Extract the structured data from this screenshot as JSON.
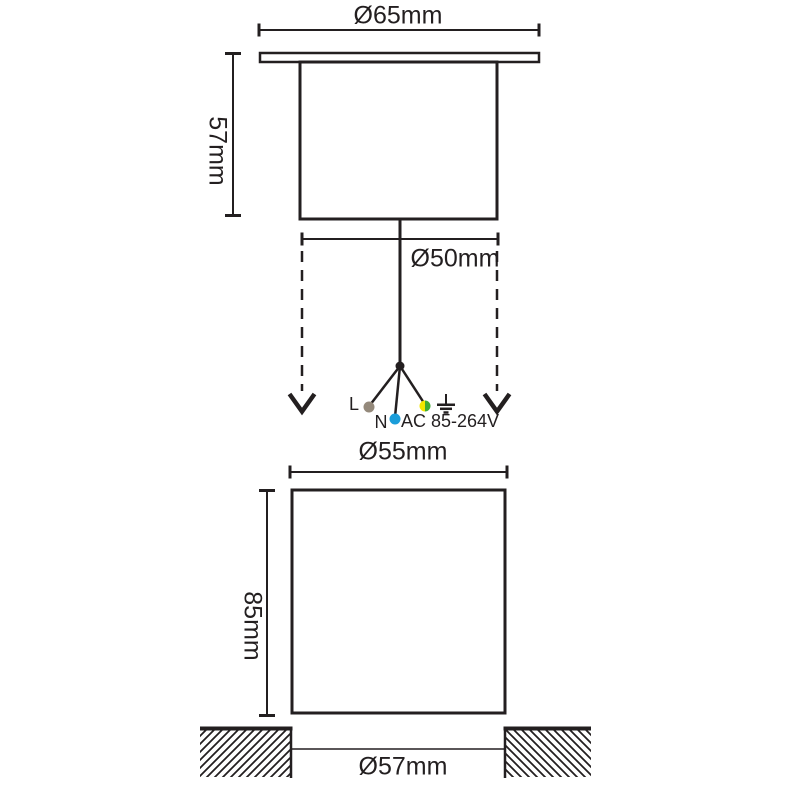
{
  "drawing": {
    "top_view": {
      "flange_diameter": "Ø65mm",
      "fixture_height": "57mm",
      "body_diameter": "Ø50mm"
    },
    "wiring": {
      "live_label": "L",
      "neutral_label": "N",
      "voltage_rating": "AC 85-264V"
    },
    "bottom_view": {
      "sleeve_diameter": "Ø55mm",
      "sleeve_height": "85mm",
      "cutout_diameter": "Ø57mm"
    }
  },
  "colors": {
    "line": "#231f20",
    "live_wire": "#94897b",
    "neutral_wire": "#1b9dd9",
    "earth_wire_yellow": "#f2e600",
    "earth_wire_green": "#3faa35"
  }
}
